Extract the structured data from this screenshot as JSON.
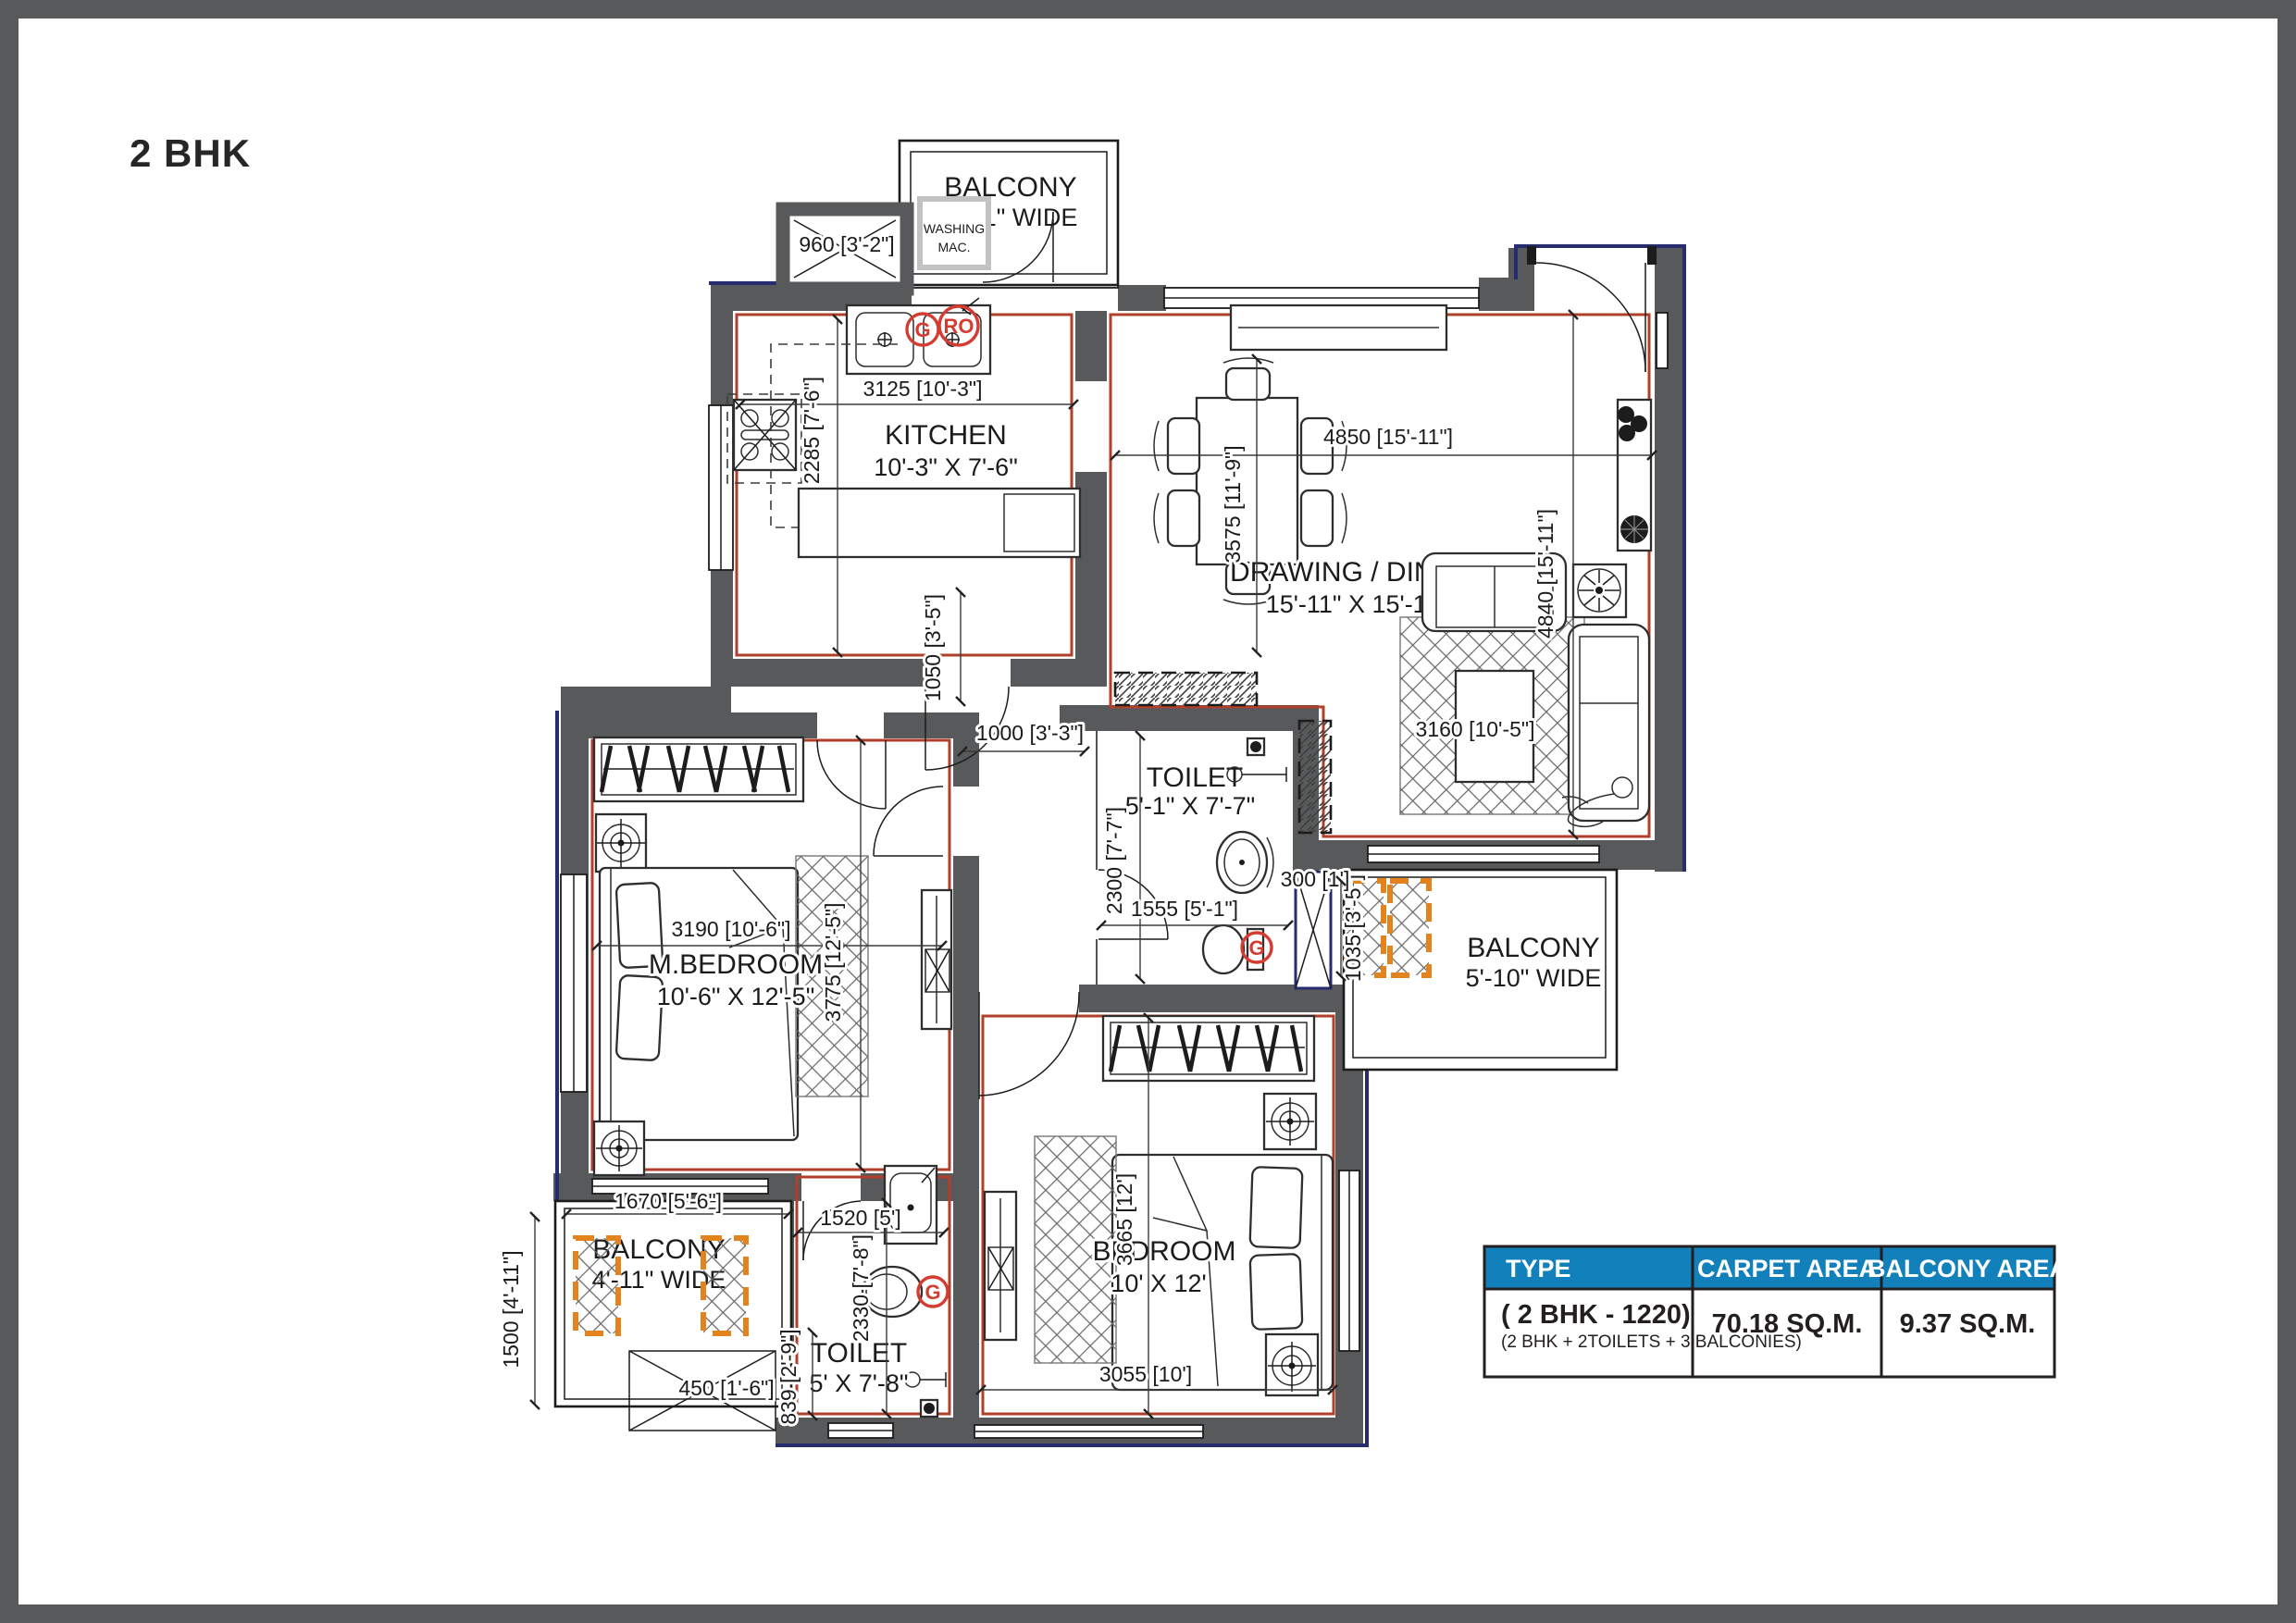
{
  "title": "2 BHK",
  "colors": {
    "wall_gray": "#58595b",
    "carpet_outline_red": "#b0402a",
    "exterior_navy": "#272c6e",
    "planter_orange": "#e2831d",
    "marker_red": "#d43c32",
    "table_header_blue": "#1280ba",
    "line_black": "#1c1c1c"
  },
  "rooms": {
    "kitchen": {
      "name": "KITCHEN",
      "size": "10'-3\" X 7'-6\""
    },
    "drawing_dining": {
      "name": "DRAWING / DINING",
      "size": "15'-11\" X 15'-11\""
    },
    "m_bedroom": {
      "name": "M.BEDROOM",
      "size": "10'-6\" X 12'-5\""
    },
    "bedroom": {
      "name": "BEDROOM",
      "size": "10' X 12'"
    },
    "toilet_mid": {
      "name": "TOILET",
      "size": "5'-1\" X 7'-7\""
    },
    "toilet_bottom": {
      "name": "TOILET",
      "size": "5' X 7'-8\""
    },
    "balcony_top": {
      "name": "BALCONY",
      "size": "3'-11\" WIDE"
    },
    "balcony_right": {
      "name": "BALCONY",
      "size": "5'-10\" WIDE"
    },
    "balcony_bottom": {
      "name": "BALCONY",
      "size": "4'-11\" WIDE"
    },
    "washing": {
      "line1": "WASHING",
      "line2": "MAC."
    }
  },
  "markers": {
    "g": "G",
    "ro": "RO"
  },
  "dims": {
    "d960": "960 [3'-2\"]",
    "d3125": "3125 [10'-3\"]",
    "d2285": "2285 [7'-6\"]",
    "d4850": "4850 [15'-11\"]",
    "d3575": "3575 [11'-9\"]",
    "d4840": "4840 [15'-11\"]",
    "d3160": "3160 [10'-5\"]",
    "d1050": "1050 [3'-5\"]",
    "d1000": "1000 [3'-3\"]",
    "d2300": "2300 [7'-7\"]",
    "d1555": "1555 [5'-1\"]",
    "d300": "300 [1']",
    "d1035": "1035 [3'-5\"]",
    "d3190": "3190 [10'-6\"]",
    "d3775": "3775 [12'-5\"]",
    "d1670": "1670 [5'-6\"]",
    "d1500": "1500 [4'-11\"]",
    "d450": "450 [1'-6\"]",
    "d1520": "1520 [5']",
    "d2330": "2330 [7'-8\"]",
    "d839": "839 [2'-9\"]",
    "d3665": "3665 [12']",
    "d3055": "3055 [10']"
  },
  "table": {
    "headers": [
      "TYPE",
      "CARPET AREA",
      "BALCONY AREA"
    ],
    "row": {
      "type": "( 2 BHK - 1220)",
      "type_sub": "(2 BHK + 2TOILETS + 3 BALCONIES)",
      "carpet": "70.18 SQ.M.",
      "balcony": "9.37 SQ.M."
    }
  }
}
